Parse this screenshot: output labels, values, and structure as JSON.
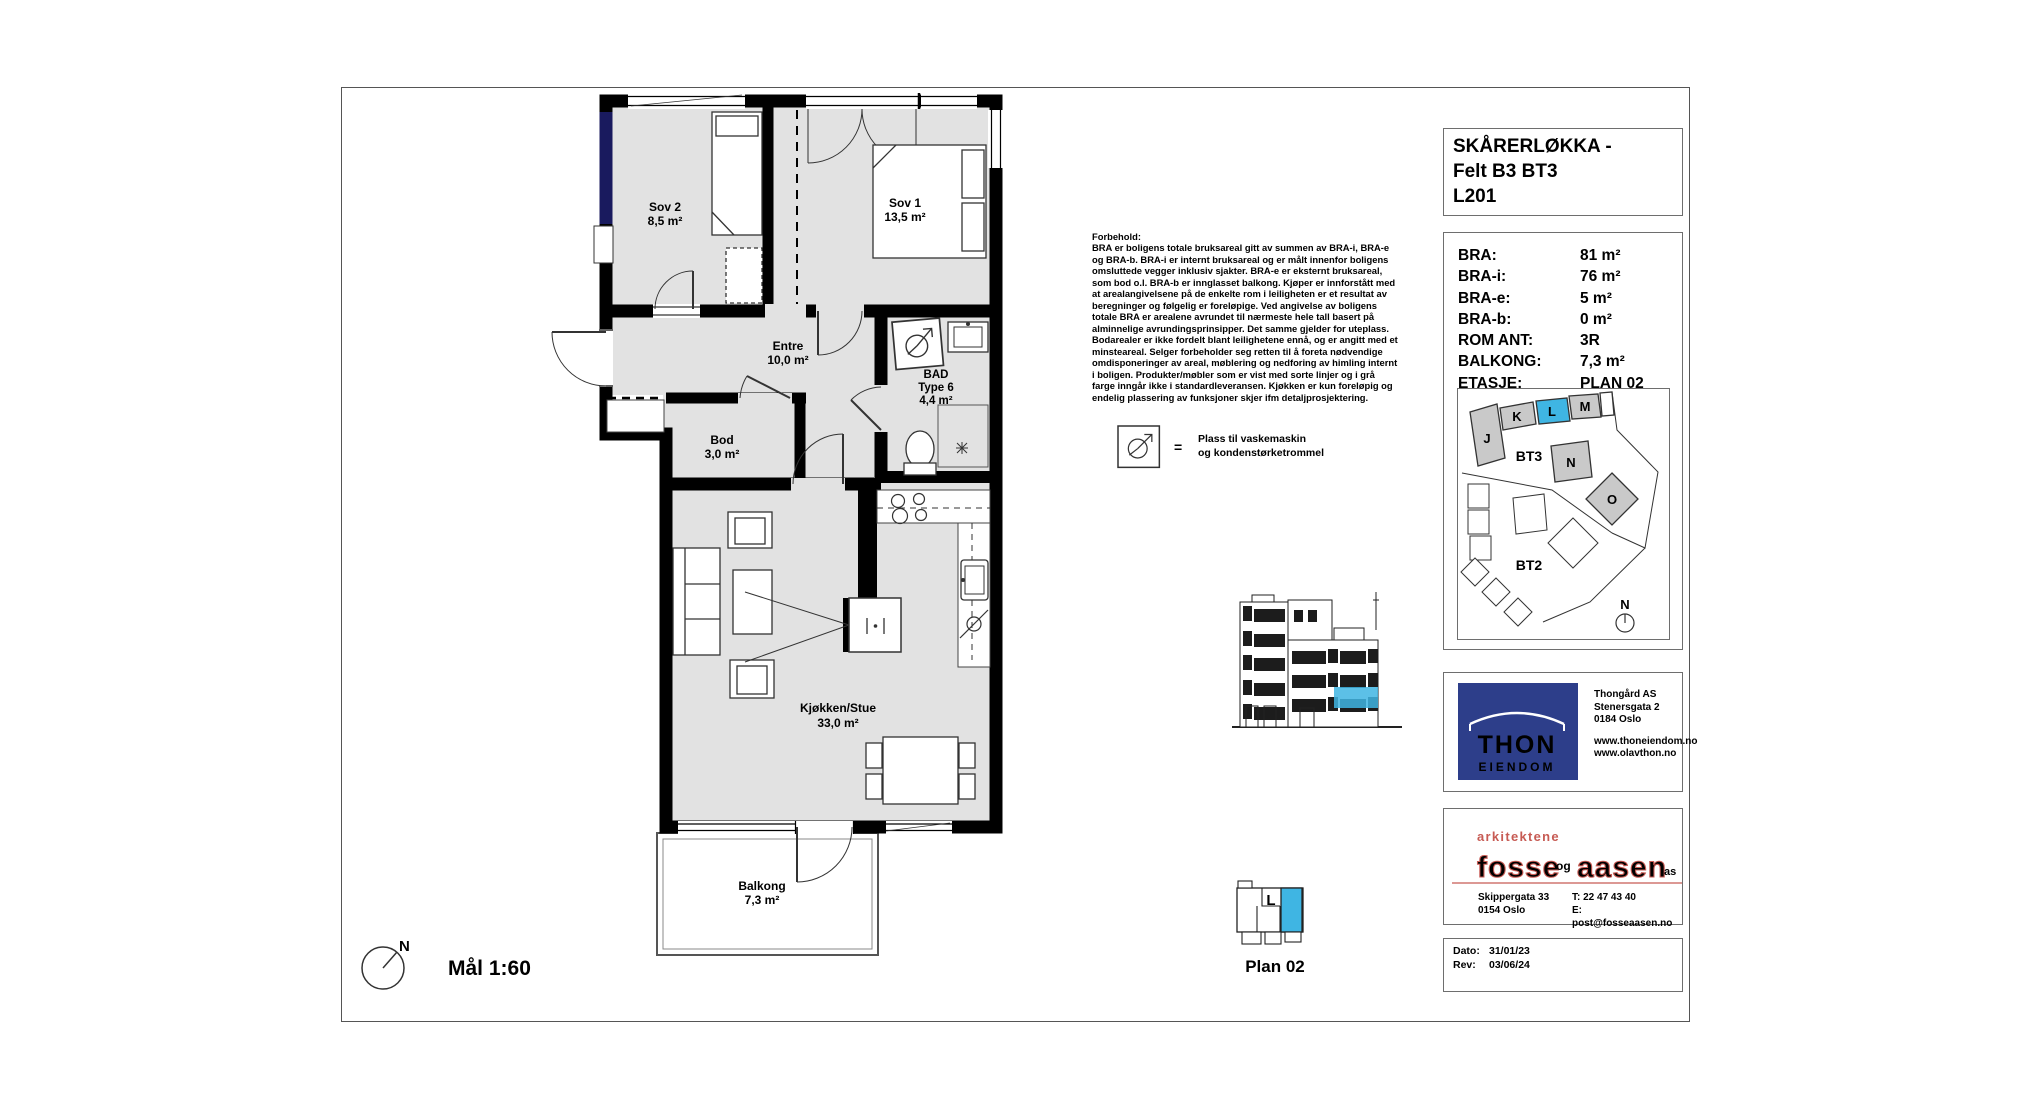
{
  "sheet": {
    "scale": "Mål 1:60",
    "plan_caption": "Plan 02",
    "north": "N"
  },
  "title_block": {
    "line1": "SKÅRERLØKKA -",
    "line2": "Felt B3 BT3",
    "line3": "L201"
  },
  "info_table": {
    "rows": [
      {
        "label": "BRA:",
        "value": "81 m²"
      },
      {
        "label": "BRA-i:",
        "value": "76 m²"
      },
      {
        "label": "BRA-e:",
        "value": "5 m²"
      },
      {
        "label": "BRA-b:",
        "value": "0 m²"
      },
      {
        "label": "ROM ANT:",
        "value": "3R"
      },
      {
        "label": "BALKONG:",
        "value": "7,3 m²"
      },
      {
        "label": "ETASJE:",
        "value": "PLAN 02"
      }
    ]
  },
  "rooms": {
    "sov2": {
      "name": "Sov 2",
      "area": "8,5 m²"
    },
    "sov1": {
      "name": "Sov 1",
      "area": "13,5 m²"
    },
    "entre": {
      "name": "Entre",
      "area": "10,0 m²"
    },
    "bad": {
      "name": "BAD",
      "type": "Type 6",
      "area": "4,4 m²"
    },
    "bod": {
      "name": "Bod",
      "area": "3,0 m²"
    },
    "stue": {
      "name": "Kjøkken/Stue",
      "area": "33,0 m²"
    },
    "balkong": {
      "name": "Balkong",
      "area": "7,3 m²"
    }
  },
  "legend": {
    "equals": "=",
    "line1": "Plass til vaskemaskin",
    "line2": "og kondenstørketrommel"
  },
  "disclaimer": {
    "heading": "Forbehold:",
    "body": "BRA er boligens totale bruksareal gitt av summen av BRA-i, BRA-e og BRA-b. BRA-i er internt bruksareal og er målt innenfor boligens omsluttede vegger inklusiv sjakter. BRA-e er eksternt bruksareal, som bod o.l. BRA-b er innglasset balkong. Kjøper er innforstått med at arealangivelsene på de enkelte rom i leiligheten er et resultat av beregninger og følgelig er foreløpige. Ved angivelse av boligens totale BRA er arealene avrundet til nærmeste hele tall basert på alminnelige avrundingsprinsipper. Det samme gjelder for uteplass. Bodarealer er ikke fordelt blant leilighetene ennå, og er angitt med et minsteareal. Selger forbeholder seg retten til å foreta nødvendige omdisponeringer av areal, møblering og nedforing av himling internt i boligen. Produkter/møbler som er vist med sorte linjer og i grå farge inngår ikke i standardleveransen. Kjøkken er kun foreløpig og endelig plassering av funksjoner skjer ifm detaljprosjektering."
  },
  "site_plan": {
    "b_j": "J",
    "b_k": "K",
    "b_l": "L",
    "b_m": "M",
    "b_n": "N",
    "b_o": "O",
    "bt3": "BT3",
    "bt2": "BT2",
    "north": "N"
  },
  "key_plan": {
    "unit": "L"
  },
  "developer": {
    "logo_main": "THON",
    "logo_sub": "EIENDOM",
    "name": "Thongård AS",
    "street": "Stenersgata 2",
    "city": "0184 Oslo",
    "web1": "www.thoneiendom.no",
    "web2": "www.olavthon.no"
  },
  "architect": {
    "tagline": "arkitektene",
    "word1": "fosse",
    "conj": "og",
    "word2": "aasen",
    "suffix": "as",
    "street": "Skippergata 33",
    "city": "0154 Oslo",
    "phone": "T: 22 47 43 40",
    "email": "E: post@fosseaasen.no"
  },
  "revision": {
    "date_label": "Dato:",
    "date_value": "31/01/23",
    "rev_label": "Rev:",
    "rev_value": "03/06/24"
  },
  "colors": {
    "highlight": "#3fb5e3",
    "thon_blue": "#2d3e8a",
    "logo_red": "#c75b54"
  }
}
